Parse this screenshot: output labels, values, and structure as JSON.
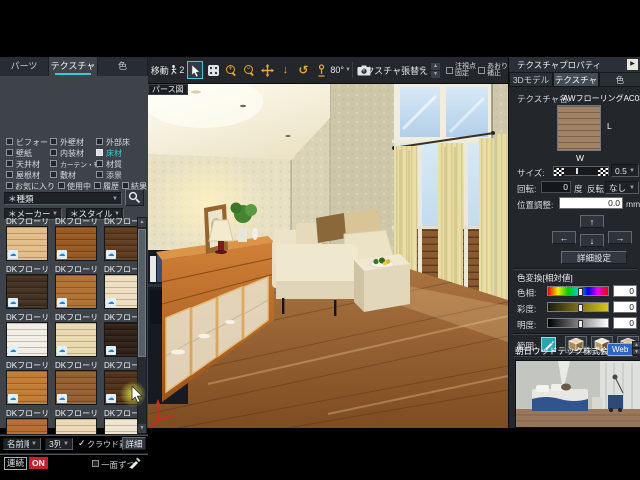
{
  "colors": {
    "accent": "#3ec9dc",
    "on-badge": "#c81f2e",
    "web-badge": "#2f66c4",
    "tb-icon": "#eda431",
    "range-btn": "#2ba4b4"
  },
  "icons": {
    "chevron_down": "▼",
    "chevron_up": "▲",
    "cloud": "☁",
    "check": "✓",
    "play": "▶",
    "arrow_left": "←",
    "arrow_up": "↑",
    "arrow_right": "→",
    "arrow_down": "↓",
    "rotate_ccw": "↺",
    "zoom_plus": "+",
    "zoom_minus": "−"
  },
  "left_panel": {
    "tabs": [
      {
        "label": "パーツ",
        "active": false
      },
      {
        "label": "テクスチャ",
        "active": true
      },
      {
        "label": "色",
        "active": false
      }
    ],
    "categories": [
      {
        "label": "ビフォー",
        "checked": false
      },
      {
        "label": "外壁材",
        "checked": false
      },
      {
        "label": "外部床",
        "checked": false
      },
      {
        "label": "壁紙",
        "checked": false
      },
      {
        "label": "内装材",
        "checked": false
      },
      {
        "label": "床材",
        "checked": true,
        "active": true
      },
      {
        "label": "天井材",
        "checked": false
      },
      {
        "label": "カーテン・布",
        "checked": false
      },
      {
        "label": "材質",
        "checked": false
      },
      {
        "label": "屋根材",
        "checked": false
      },
      {
        "label": "敷材",
        "checked": false
      },
      {
        "label": "添景",
        "checked": false
      }
    ],
    "filters": [
      {
        "label": "お気に入り"
      },
      {
        "label": "使用中"
      },
      {
        "label": "履歴"
      },
      {
        "label": "結果"
      }
    ],
    "kind_select": "＊種類",
    "maker_select": "＊メーカー",
    "style_select": "＊スタイル",
    "swatches": {
      "items": [
        {
          "name": "DKフローリン...",
          "color": "#e3bc85"
        },
        {
          "name": "DKフローリン...",
          "color": "#95551f"
        },
        {
          "name": "DKフローリン...",
          "color": "#5a371b"
        },
        {
          "name": "DKフローリン...",
          "color": "#3f2d1c"
        },
        {
          "name": "DKフローリン...",
          "color": "#b06f2e"
        },
        {
          "name": "DKフローリン...",
          "color": "#eedec0"
        },
        {
          "name": "DKフローリン...",
          "color": "#f3eee4"
        },
        {
          "name": "DKフローリン...",
          "color": "#e9d9ae"
        },
        {
          "name": "DKフローリン...",
          "color": "#2c1d13"
        },
        {
          "name": "DKフローリン...",
          "color": "#c1792f"
        },
        {
          "name": "DKフローリン...",
          "color": "#925c2c"
        },
        {
          "name": "DKフローリン...",
          "color": "#4c2e17"
        },
        {
          "name": "DKフローリン...",
          "color": "#b5692f"
        },
        {
          "name": "DKフローリン...",
          "color": "#ecd9b4"
        },
        {
          "name": "DKフローリン...",
          "color": "#efe5cf"
        }
      ]
    },
    "sort_select": "名前順",
    "columns_select": "3列",
    "cloud_checkbox_label": "クラウド素材",
    "detail_button": "詳細",
    "continuous_label": "連続",
    "on_badge": "ON",
    "one_face_label": "一面ずつ"
  },
  "toolbar": {
    "move_label": "移動",
    "walk_count": "2",
    "view_angle": "80°",
    "texture_replace_label": "テクスチャ張替え",
    "fix_gaze_line1": "注視点",
    "fix_gaze_line2": "固定",
    "tilt_line1": "あおり",
    "tilt_line2": "補正"
  },
  "viewport": {
    "label": "パース図"
  },
  "right_panel": {
    "title": "テクスチャプロパティ",
    "tabs": [
      {
        "label": "3Dモデル",
        "active": false
      },
      {
        "label": "テクスチャ",
        "active": true
      },
      {
        "label": "色",
        "active": false
      }
    ],
    "texture_name_label": "テクスチャ名:",
    "texture_name": "AWフローリングAC03",
    "preview_l": "L",
    "preview_w": "W",
    "size_label": "サイズ:",
    "size_value": "0.5倍",
    "rotation_label": "回転:",
    "rotation_value": "0",
    "degree_label": "度",
    "flip_label": "反転",
    "flip_value": "なし",
    "position_label": "位置調整:",
    "position_value": "0.0",
    "position_unit": "mm",
    "detail_button": "詳細設定",
    "color_section_title": "色変換[相対値]",
    "hue_label": "色相:",
    "hue_value": "0",
    "sat_label": "彩度:",
    "sat_value": "0",
    "bri_label": "明度:",
    "bri_value": "0",
    "range_label": "範囲:",
    "company": "朝日ウッドテック株式会社",
    "web_badge": "Web"
  }
}
